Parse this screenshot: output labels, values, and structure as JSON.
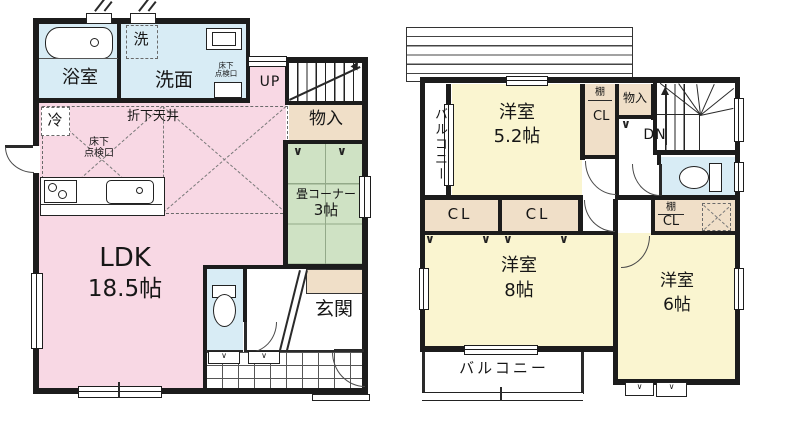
{
  "plan_title": "2-story house floor plan",
  "colors": {
    "wall": "#1c1c1c",
    "pink": "#f8d8e4",
    "yellow": "#faf5d0",
    "green": "#cfe2c4",
    "blue": "#d8ecf5",
    "tan": "#f0dfc8"
  },
  "icons": {
    "fold_mark": "∨"
  },
  "f1": {
    "bath": "浴室",
    "laundry": "洗",
    "washroom": "洗面",
    "hatch_a_l1": "床下",
    "hatch_a_l2": "点検口",
    "up": "UP",
    "storage": "物入",
    "fridge": "冷",
    "lowered_ceiling": "折下天井",
    "hatch_b_l1": "床下",
    "hatch_b_l2": "点検口",
    "tatami_name": "畳コーナー",
    "tatami_size": "3帖",
    "ldk_name": "LDK",
    "ldk_size": "18.5帖",
    "entrance": "玄関"
  },
  "f2": {
    "balcony_side": "バルコニー",
    "room52_name": "洋室",
    "room52_size": "5.2帖",
    "shelf_a": "棚",
    "closet_a": "CL",
    "storage": "物入",
    "down": "DN",
    "shelf_b": "棚",
    "closet_b": "CL",
    "closet_c": "CL",
    "closet_d": "CL",
    "room8_name": "洋室",
    "room8_size": "8帖",
    "room6_name": "洋室",
    "room6_size": "6帖",
    "balcony_bottom": "バルコニー"
  }
}
